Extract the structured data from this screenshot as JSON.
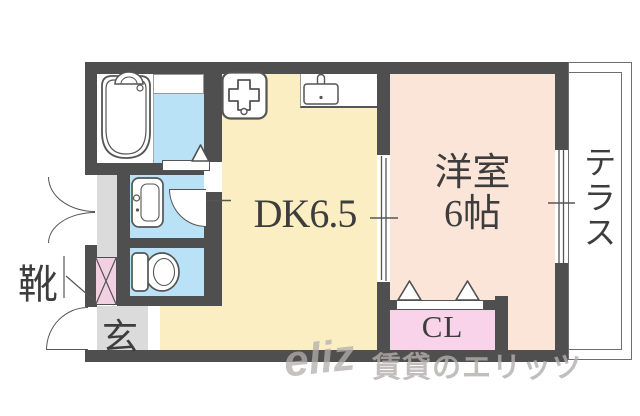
{
  "image_type": "apartment-floor-plan",
  "colors": {
    "wall": "#4f4f4f",
    "dk": "#faeec2",
    "western": "#fbe5d8",
    "wet": "#b9e2f6",
    "closet": "#f8d3e9",
    "shoe": "#f3cfe2",
    "entrance": "#dbdbdb",
    "terraceline": "#6e6e6e",
    "text": "#3d3d3d",
    "watermark": "#b3aeae"
  },
  "rooms": {
    "dining_kitchen": {
      "label": "DK6.5"
    },
    "western_room": {
      "label": "洋室",
      "size": "6帖"
    },
    "terrace": {
      "label": "テラス"
    },
    "closet": {
      "label": "CL"
    },
    "entrance": {
      "label": "玄"
    },
    "shoe_cabinet": {
      "label": "靴"
    }
  },
  "fixtures": [
    "bathtub",
    "gas-stove",
    "kitchen-sink",
    "washbasin",
    "toilet",
    "shoe-cabinet",
    "bathroom-folding-door",
    "closet-folding-door",
    "sliding-door",
    "window",
    "entrance-door",
    "double-door"
  ],
  "watermark": {
    "logo": "eliz",
    "text": "賃貸のエリッツ"
  }
}
